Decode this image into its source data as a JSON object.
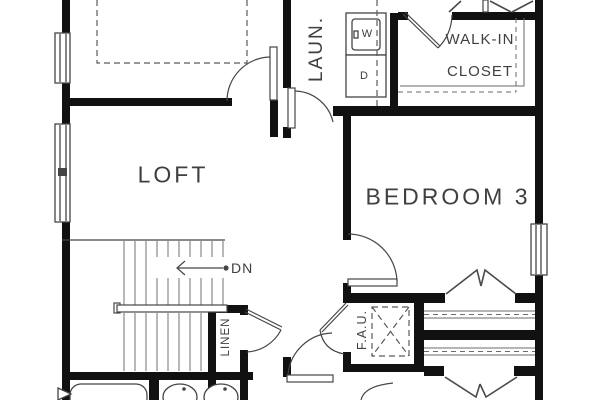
{
  "plan": {
    "title": "second-floor-plan",
    "rooms": {
      "loft": "LOFT",
      "bedroom3": "BEDROOM 3",
      "walk_in_line1": "WALK-IN",
      "walk_in_line2": "CLOSET",
      "laundry": "LAUN.",
      "linen": "LINEN",
      "fau": "F.A.U."
    },
    "stairs": {
      "down_label": "DN"
    },
    "appliances": {
      "washer": "W",
      "dryer": "D"
    },
    "colors": {
      "wall": "#111111",
      "line": "#454545",
      "tread": "#7d7d7d",
      "dashed": "#5a5a5a",
      "text": "#3f3f3f"
    }
  }
}
